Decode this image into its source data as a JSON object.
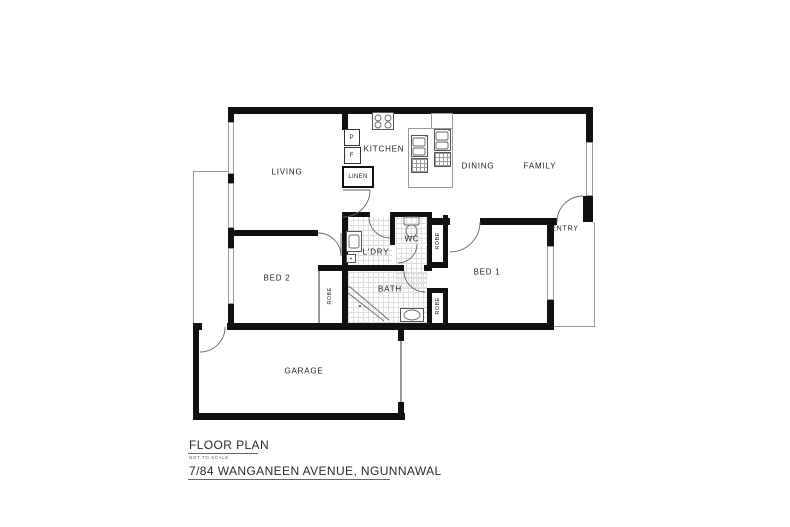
{
  "title_block": {
    "title": "FLOOR PLAN",
    "scale_note": "NOT TO SCALE",
    "address": "7/84 WANGANEEN AVENUE, NGUNNAWAL"
  },
  "rooms": {
    "living": "LIVING",
    "kitchen": "KITCHEN",
    "dining": "DINING",
    "family": "FAMILY",
    "bed1": "BED 1",
    "bed2": "BED 2",
    "bath": "BATH",
    "laundry": "L'DRY",
    "wc": "WC",
    "entry": "ENTRY",
    "garage": "GARAGE",
    "linen": "LINEN",
    "robe": "ROBE",
    "pantry": "P",
    "fridge": "F"
  },
  "colors": {
    "wall": "#111111",
    "line": "#9a9a9a",
    "tile": "#dedede",
    "text": "#1d1d1d",
    "bg": "#ffffff",
    "fix": "#555555"
  }
}
